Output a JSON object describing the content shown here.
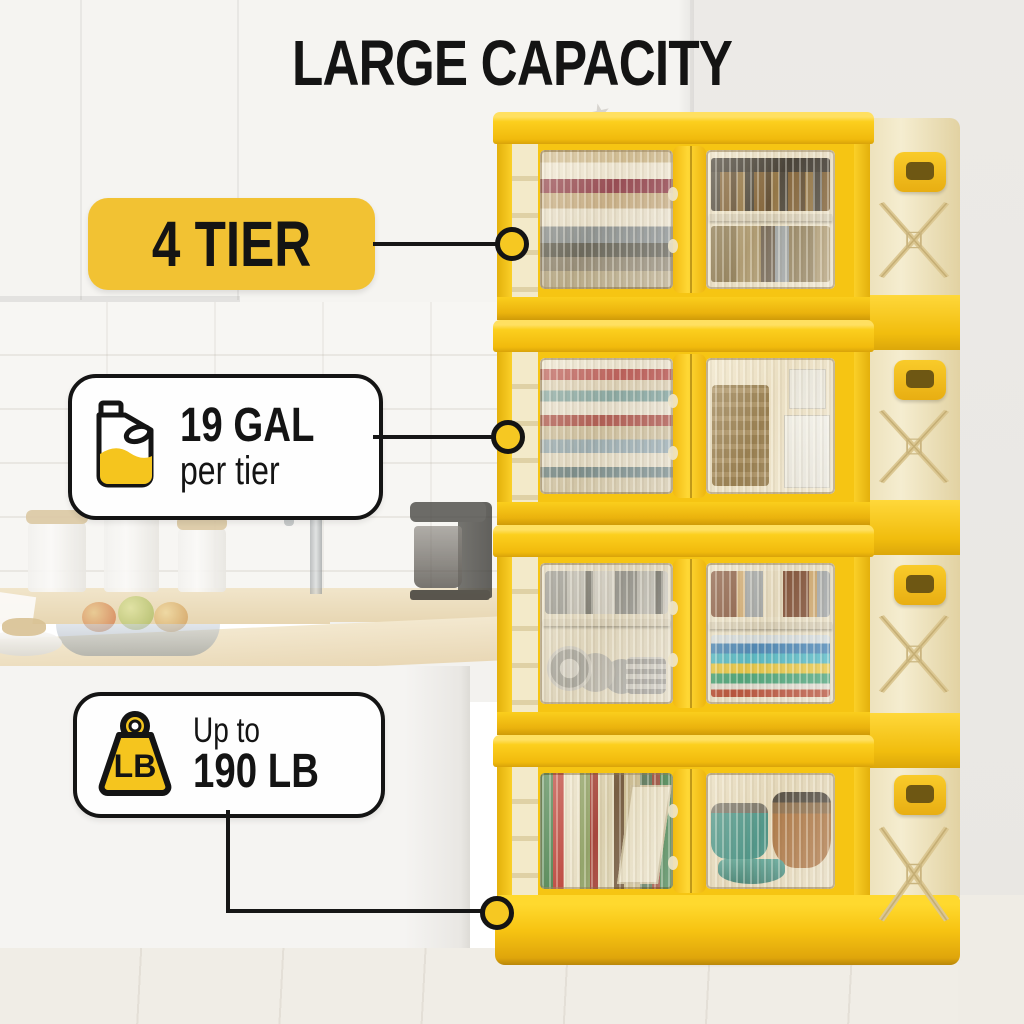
{
  "title": "LARGE CAPACITY",
  "callouts": {
    "tier": {
      "label": "4 TIER"
    },
    "capacity": {
      "value": "19 GAL",
      "note": "per tier"
    },
    "weight": {
      "prefix": "Up to",
      "value": "190 LB",
      "icon_text": "LB"
    }
  },
  "cabinet": {
    "tier_count": 4,
    "tiers": [
      {
        "name": "tier-1",
        "left_contents": "folded-linens-towels",
        "right_contents": "pantry-jars-canisters"
      },
      {
        "name": "tier-2",
        "left_contents": "folded-clothes",
        "right_contents": "basket-and-boxes"
      },
      {
        "name": "tier-3",
        "left_contents": "plates-and-pans",
        "right_contents": "cups-and-books"
      },
      {
        "name": "tier-4",
        "left_contents": "books",
        "right_contents": "cookware-pots"
      }
    ]
  },
  "colors": {
    "accent_yellow": "#F2C233",
    "cabinet_yellow": "#FAC911",
    "dot_yellow": "#F6C822",
    "panel_cream": "#F1E7C6",
    "text_black": "#141414"
  }
}
